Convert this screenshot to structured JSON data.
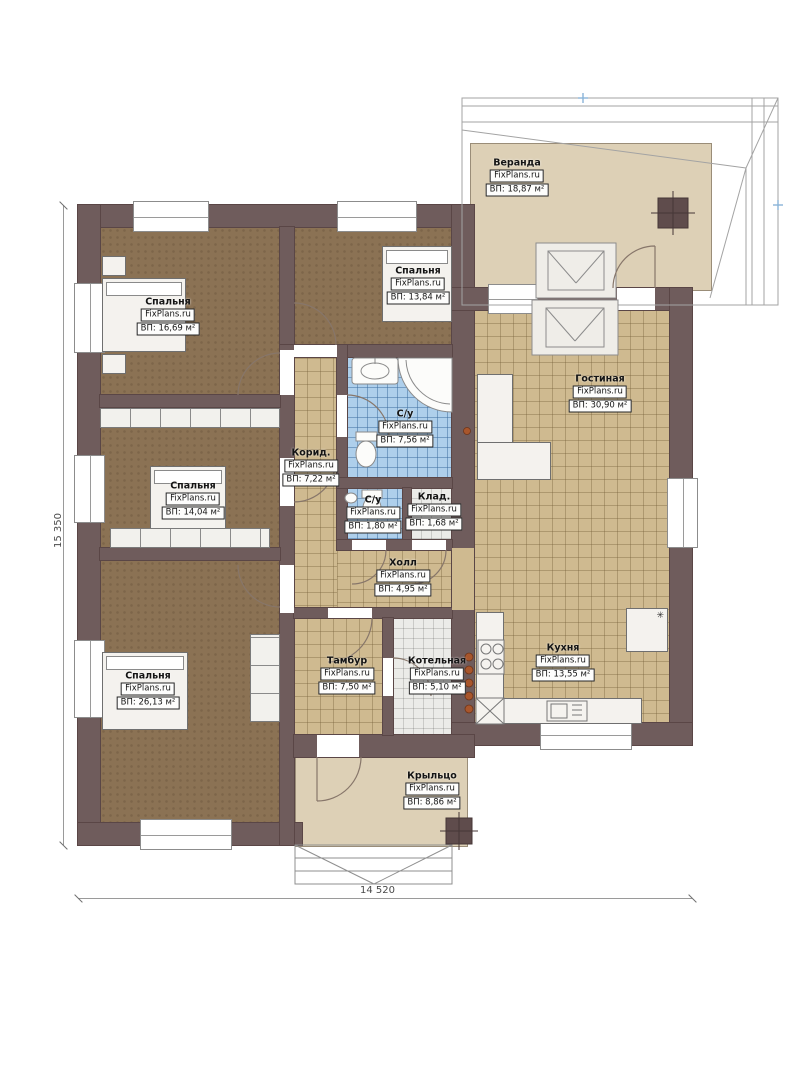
{
  "plan": {
    "watermark": "FixPlans.ru",
    "rooms": [
      {
        "key": "veranda",
        "name": "Веранда",
        "area": "ВП: 18,87 м²"
      },
      {
        "key": "bedroom-1",
        "name": "Спальня",
        "area": "ВП: 16,69 м²"
      },
      {
        "key": "bedroom-2",
        "name": "Спальня",
        "area": "ВП: 13,84 м²"
      },
      {
        "key": "living-room",
        "name": "Гостиная",
        "area": "ВП: 30,90 м²"
      },
      {
        "key": "bathroom",
        "name": "С/у",
        "area": "ВП: 7,56 м²"
      },
      {
        "key": "corridor",
        "name": "Корид.",
        "area": "ВП: 7,22 м²"
      },
      {
        "key": "bedroom-3",
        "name": "Спальня",
        "area": "ВП: 14,04 м²"
      },
      {
        "key": "wc",
        "name": "С/у",
        "area": "ВП: 1,80 м²"
      },
      {
        "key": "storage",
        "name": "Клад.",
        "area": "ВП: 1,68 м²"
      },
      {
        "key": "hall",
        "name": "Холл",
        "area": "ВП: 4,95 м²"
      },
      {
        "key": "bedroom-4",
        "name": "Спальня",
        "area": "ВП: 26,13 м²"
      },
      {
        "key": "tambour",
        "name": "Тамбур",
        "area": "ВП: 7,50 м²"
      },
      {
        "key": "boiler-room",
        "name": "Котельная",
        "area": "ВП: 5,10 м²"
      },
      {
        "key": "kitchen",
        "name": "Кухня",
        "area": "ВП: 13,55 м²"
      },
      {
        "key": "porch",
        "name": "Крыльцо",
        "area": "ВП: 8,86 м²"
      }
    ],
    "dimensions": {
      "bottom": "14 520",
      "left": "15 350"
    },
    "icons": {
      "snowflake": "✳"
    },
    "colors": {
      "wall": "#6f5c5c",
      "bedroom_floor": "#8b7254",
      "tile_floor": "#cfba90",
      "bath_tile": "#aecfeb",
      "utility_tile": "#ebebe8",
      "deck": "#ddd0b6",
      "pipe_dot": "#a8562c"
    }
  }
}
